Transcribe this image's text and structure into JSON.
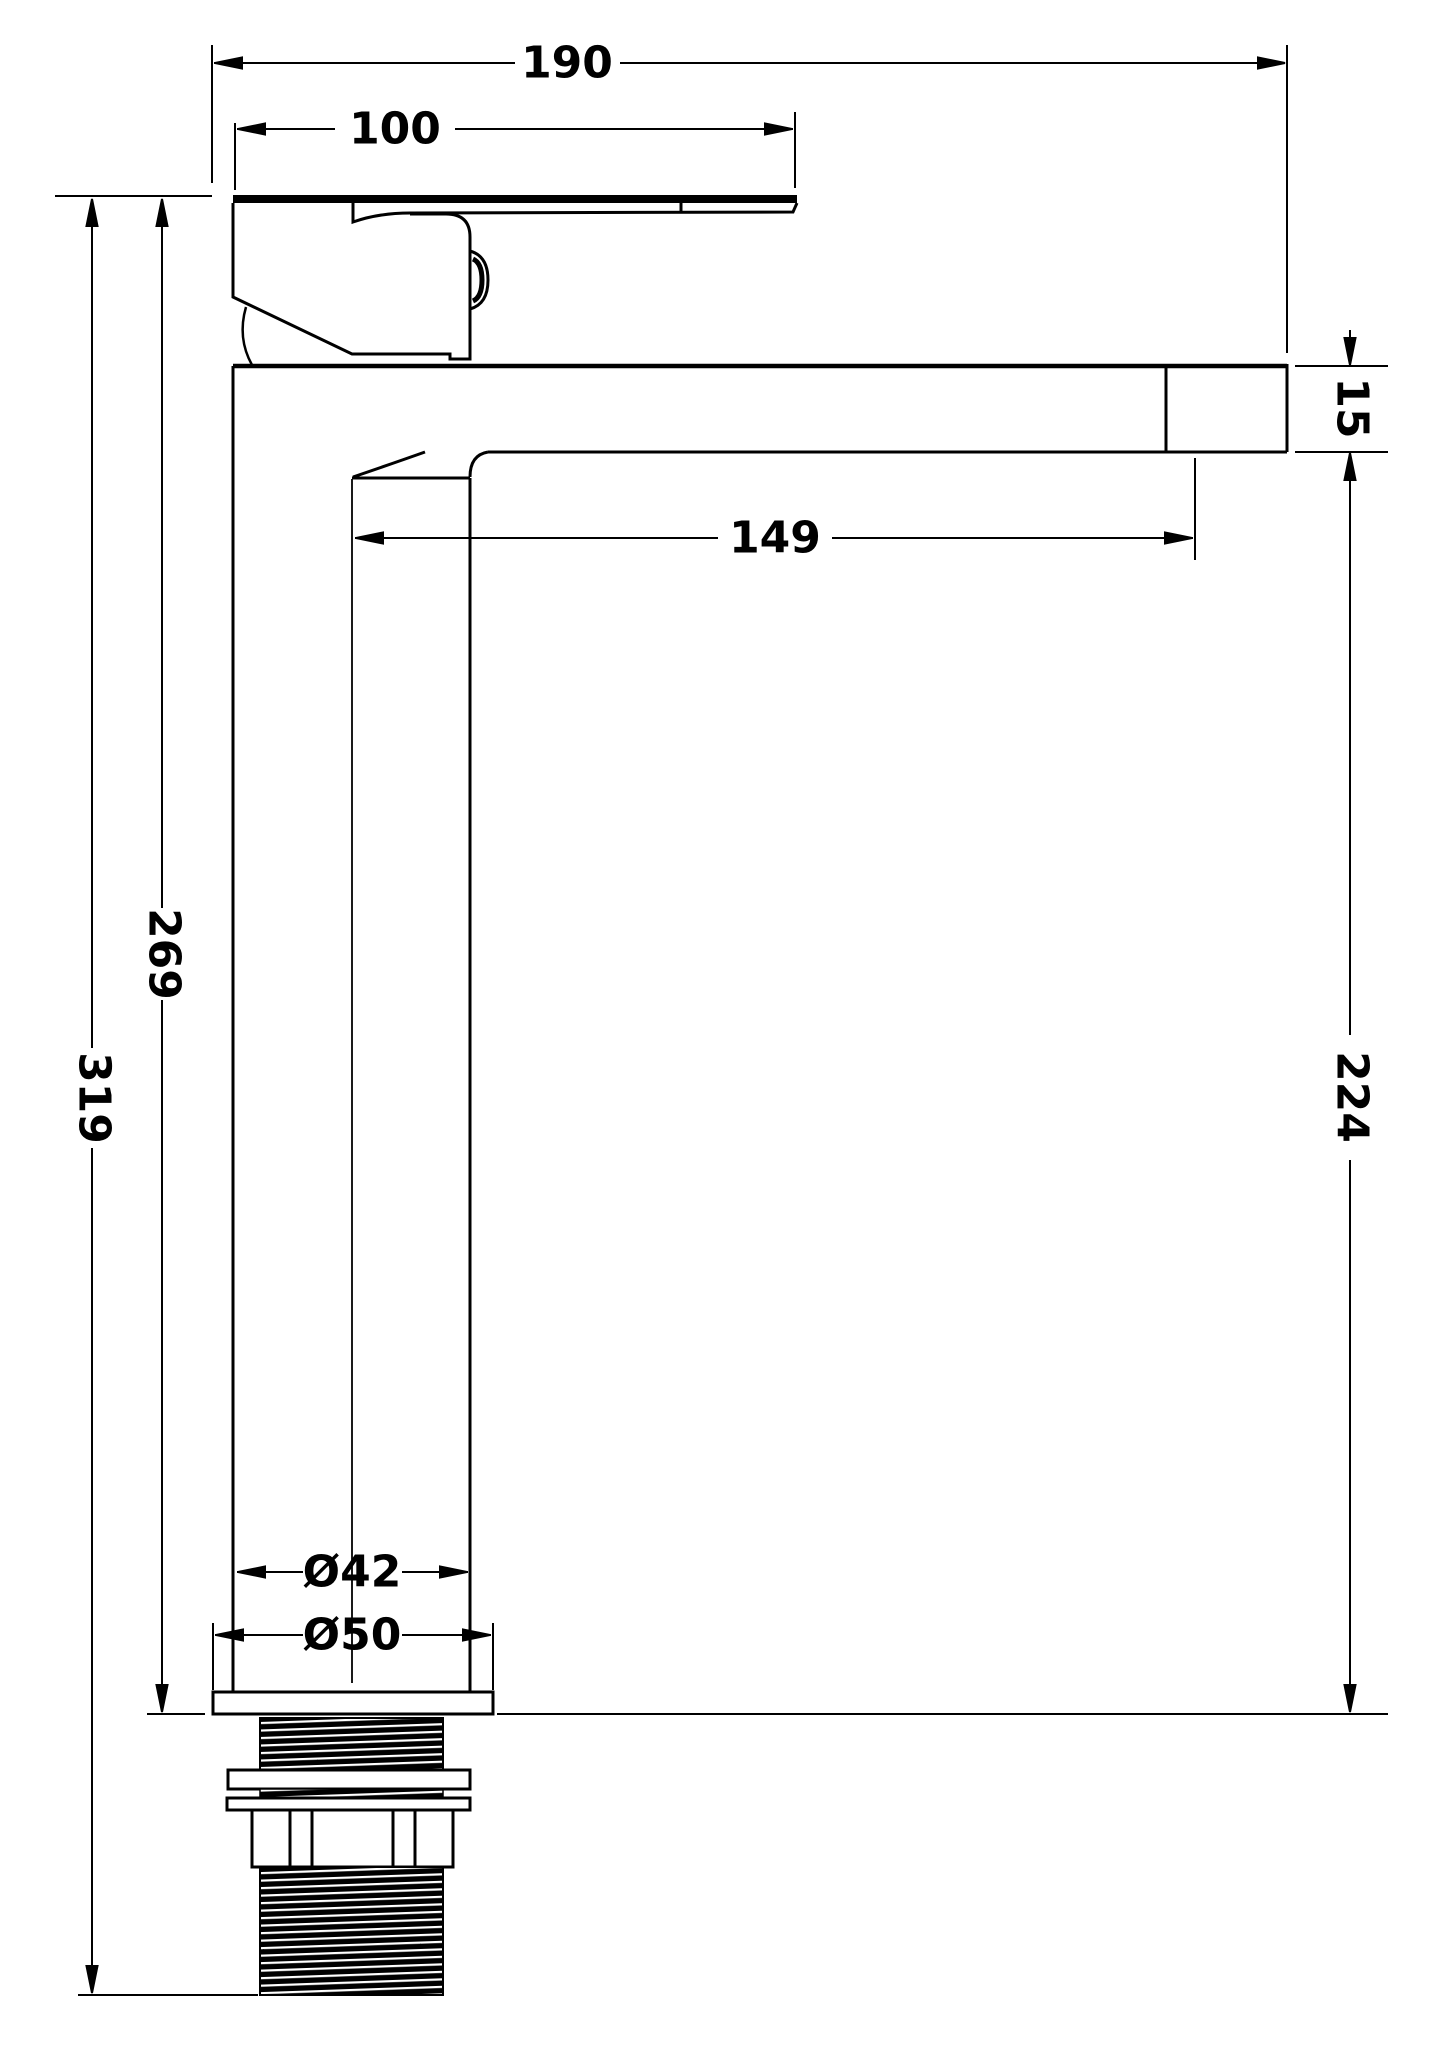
{
  "drawing": {
    "line_color": "#000000",
    "background_color": "#ffffff",
    "dims": {
      "overall_width": "190",
      "handle_length": "100",
      "spout_reach": "149",
      "spout_end_height": "15",
      "body_height": "269",
      "total_height": "319",
      "clearance_height": "224",
      "column_diameter": "Ø42",
      "base_diameter": "Ø50"
    }
  }
}
